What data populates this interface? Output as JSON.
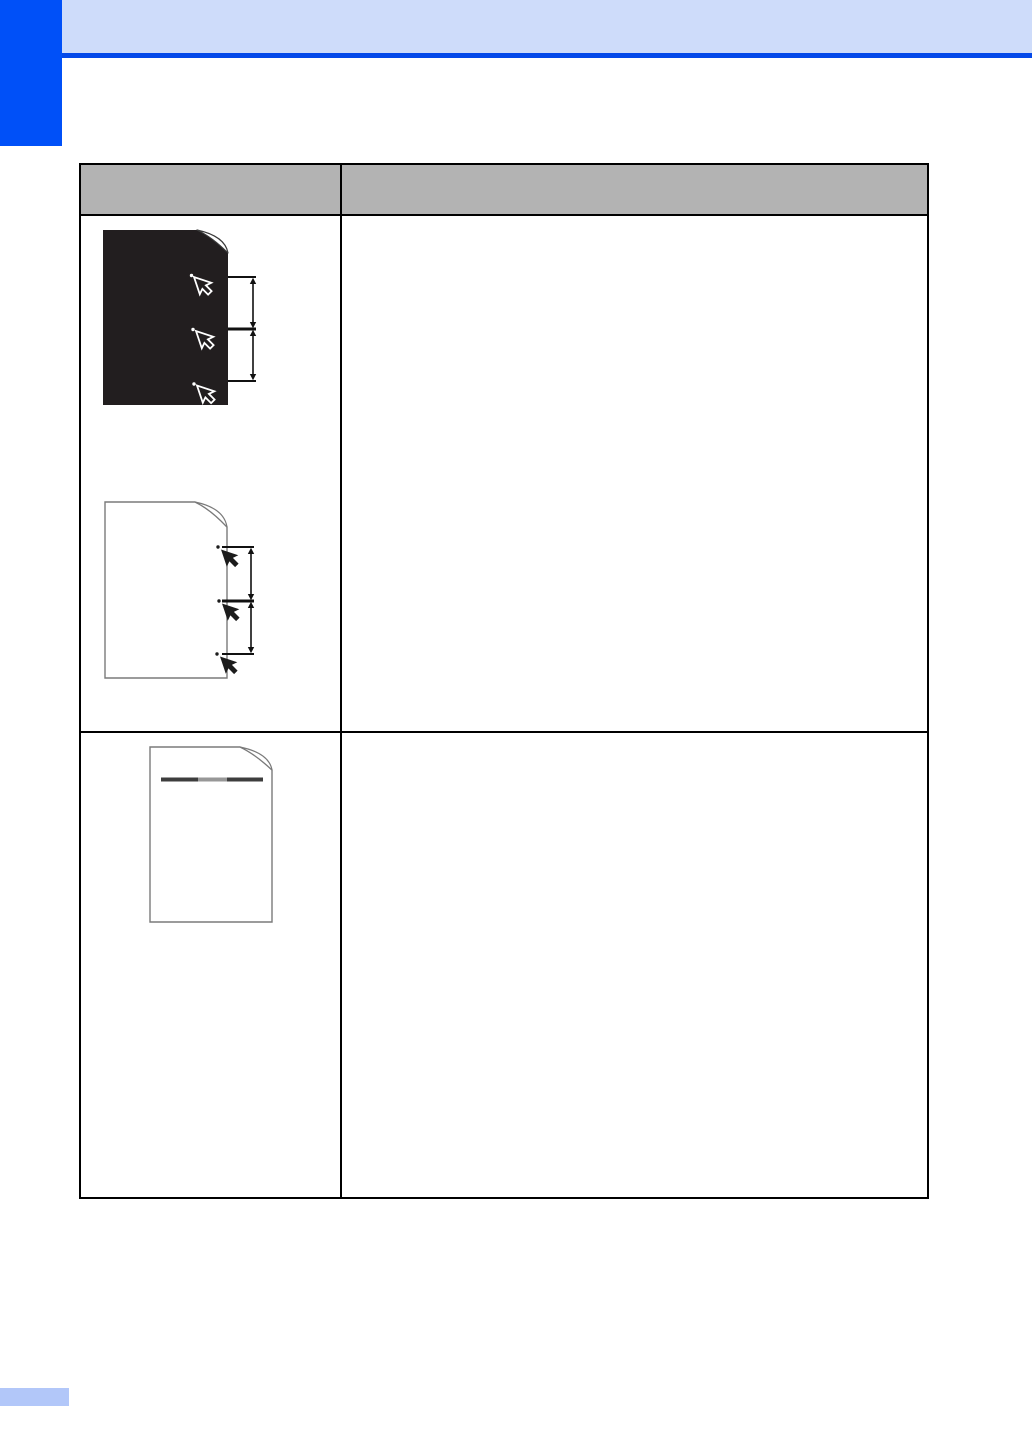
{
  "page": {
    "width": 1032,
    "height": 1456,
    "background": "#ffffff"
  },
  "colors": {
    "accent_blue": "#0050f8",
    "rule_blue": "#0449e9",
    "band_blue": "#cedcfa",
    "footer_blue": "#b2c7f9",
    "header_gray": "#b3b3b3",
    "table_border": "#000000",
    "figure_black": "#221e1f",
    "outline_gray": "#7a7a7a",
    "band_dark": "#3d3d3d",
    "band_light": "#979797"
  },
  "header": {
    "band_text": "",
    "chapter_tab_text": ""
  },
  "table": {
    "columns": 2,
    "header": {
      "cells": [
        "",
        ""
      ]
    },
    "rows": [
      {
        "left_cell_figures": [
          "white-spots-on-black-page",
          "dark-spots-on-white-page"
        ],
        "right_cell_text": ""
      },
      {
        "left_cell_figures": [
          "horizontal-band-across-page"
        ],
        "right_cell_text": ""
      }
    ]
  },
  "figures": {
    "white_spots_on_black_page": {
      "page_fill": "black",
      "marks": 3,
      "mark_icon": "cursor-arrow-icon",
      "mark_style": "white-outline",
      "dimension_intervals": 2
    },
    "dark_spots_on_white_page": {
      "page_fill": "white",
      "marks": 3,
      "mark_icon": "cursor-arrow-icon",
      "mark_style": "solid-black",
      "dimension_intervals": 2
    },
    "horizontal_band_across_page": {
      "page_fill": "white",
      "band_segments": 3
    }
  },
  "footer": {
    "marker_text": ""
  }
}
